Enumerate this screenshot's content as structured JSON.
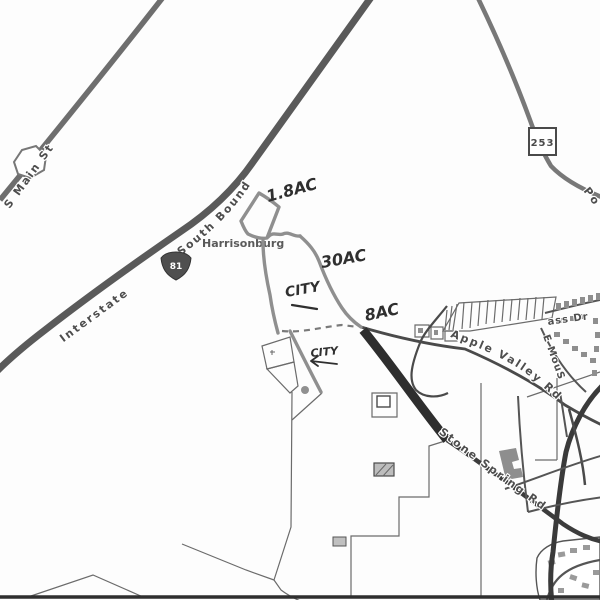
{
  "city_label": "Harrisonburg",
  "roads": {
    "i81": {
      "part1": "Interstate",
      "shield": "81",
      "part2": "South Bound"
    },
    "s_main": {
      "name": "S Main St"
    },
    "route253": {
      "shield": "253"
    },
    "port_republic": {
      "partial_name": "Po"
    },
    "apple_valley": {
      "name": "Apple Valley Rd"
    },
    "stone_spring": {
      "name": "Stone Spring Rd"
    },
    "mass_dr": {
      "partial_name": "ass Dr"
    },
    "e_mous": {
      "partial_name": "E MouS"
    }
  },
  "annotations": {
    "acreage_upper": "1.8AC",
    "acreage_middle": "30AC",
    "acreage_lower": "8AC",
    "city_upper": "CITY",
    "city_lower": "CITY"
  },
  "colors": {
    "paper": "#fdfdfd",
    "road_dark": "#2e2e2e",
    "road_medium": "#5a5a5a",
    "road_light": "#787878",
    "parcel_line": "#6b6b6b",
    "pencil": "#8f8f8f",
    "ink": "#2f2f2f",
    "label": "#4e4e4e"
  }
}
